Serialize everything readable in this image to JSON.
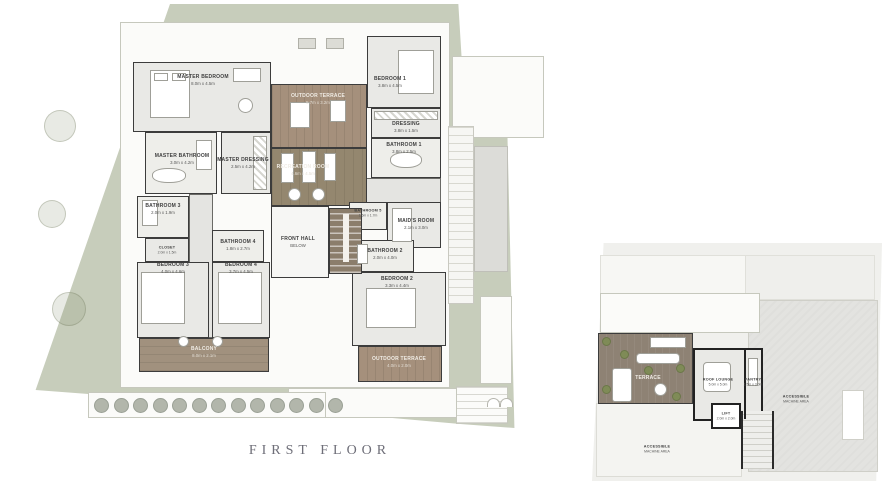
{
  "caption": {
    "text": "FIRST FLOOR"
  },
  "palette": {
    "site_green": "#c7cdbb",
    "wood_terrace": "#a5907c",
    "recreation_wood": "#94876f",
    "roof_terrace_brown": "#8e8274",
    "plant_green": "#7f8b57",
    "wall": "#3c3c3c",
    "room_fill": "#e9e9e6",
    "roof_white": "#fbfbf9",
    "caption_text": "#6e6e78"
  },
  "floor_plan": {
    "labels": {
      "master_bedroom": {
        "line1": "MASTER BEDROOM",
        "line2": "8.0m x 4.5m"
      },
      "master_bathroom": {
        "line1": "MASTER BATHROOM",
        "line2": "3.0m x 4.2m"
      },
      "master_dressing": {
        "line1": "MASTER DRESSING",
        "line2": "2.5m x 4.2m"
      },
      "outdoor_terrace_top": {
        "line1": "OUTDOOR TERRACE",
        "line2": "5.7m x 3.2m"
      },
      "recreation_room": {
        "line1": "RECREATION ROOM",
        "line2": "4.6m x 4.5m"
      },
      "bedroom_1": {
        "line1": "BEDROOM 1",
        "line2": "3.8m x 4.5m"
      },
      "dressing": {
        "line1": "DRESSING",
        "line2": "3.8m x 1.5m"
      },
      "bathroom_1": {
        "line1": "BATHROOM 1",
        "line2": "3.8m x 2.5m"
      },
      "bathroom_5": {
        "line1": "BATHROOM 5",
        "line2": "1.6m x 1.7m"
      },
      "maids_room": {
        "line1": "MAID'S ROOM",
        "line2": "2.1m x 3.0m"
      },
      "bathroom_2": {
        "line1": "BATHROOM 2",
        "line2": "2.0m x 4.0m"
      },
      "bedroom_2": {
        "line1": "BEDROOM 2",
        "line2": "3.3m x 4.4m"
      },
      "outdoor_terrace_bottom": {
        "line1": "OUTDOOR TERRACE",
        "line2": "4.0m x 2.0m"
      },
      "bathroom_3": {
        "line1": "BATHROOM 3",
        "line2": "2.0m x 1.9m"
      },
      "closet": {
        "line1": "CLOSET",
        "line2": "2.0m x 1.5m"
      },
      "bedroom_3": {
        "line1": "BEDROOM 3",
        "line2": "4.0m x 4.6m"
      },
      "bathroom_4": {
        "line1": "BATHROOM 4",
        "line2": "1.8m x 2.7m"
      },
      "bedroom_4": {
        "line1": "BEDROOM 4",
        "line2": "3.7m x 4.5m"
      },
      "balcony": {
        "line1": "BALCONY",
        "line2": "8.0m x 2.1m"
      },
      "front_hall": {
        "line1": "FRONT HALL",
        "line2": "BELOW"
      }
    }
  },
  "roof_plan": {
    "labels": {
      "terrace": {
        "line1": "TERRACE",
        "line2": ""
      },
      "roof_lounge": {
        "line1": "ROOF LOUNGE",
        "line2": "5.0m x 5.0m"
      },
      "pantry": {
        "line1": "PANTRY",
        "line2": "1.5m x 3.0m"
      },
      "lift": {
        "line1": "LIFT",
        "line2": "2.0m x 2.0m"
      },
      "machine_right": {
        "line1": "ACCESSIBLE",
        "line2": "MACHINE AREA"
      },
      "machine_bottom": {
        "line1": "ACCESSIBLE",
        "line2": "MACHINE AREA"
      }
    }
  }
}
